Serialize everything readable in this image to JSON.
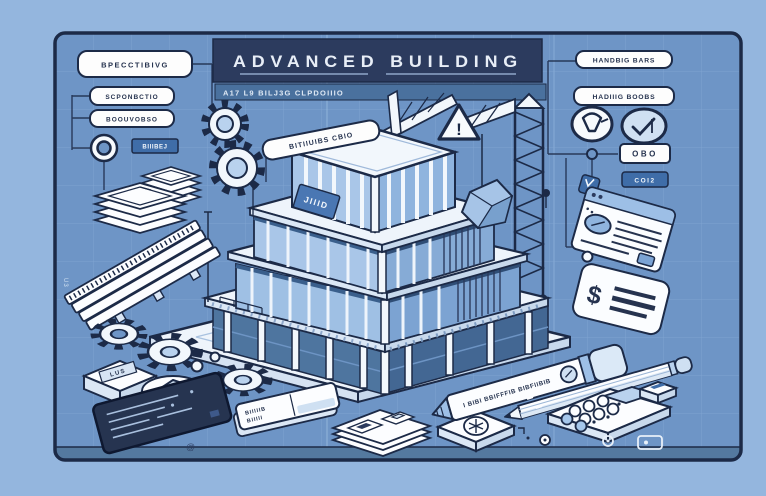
{
  "palette": {
    "outer_background": "#94b6de",
    "panel_background": "#6e95c6",
    "grid_line": "#7fa4d0",
    "ink_outline": "#1c2a47",
    "banner_background": "#2c3b5e",
    "banner_text": "#e8eef7",
    "subtitle_strip": "#4a719e",
    "object_white": "#fcfdff",
    "glass_light": "#b9d2ee",
    "glass_mid": "#7ca3d2",
    "glass_dark": "#3f6899",
    "accent_tag_blue": "#3f6da8",
    "tablet_dark": "#263450"
  },
  "title_block": {
    "title": "ADVANCED BUILDING",
    "subtitle": "A17 L9 BILJ3G CLPDOIIIO"
  },
  "labels": {
    "left_1": "BPECCTIBIVG",
    "left_2": "SCPONBCTIO",
    "left_3": "BOOUVOBSO",
    "left_tag": "BIIIBEJ",
    "right_1": "HANDBIG BARS",
    "right_2": "HADIIIG BOOBS",
    "right_tag_1": "OBO",
    "right_tag_2": "COI2",
    "building_flag": "BITIIUIBS CBIO",
    "building_sign": "JIIID",
    "crate_tag": "LUS",
    "eraser_line_1": "BIIIIIB",
    "eraser_line_2": "BIIIII",
    "marker_text": "I BIBI BBIFFFIB BIBFIIBIB",
    "warning_mark": "!",
    "card_symbol": "$",
    "edge_mark": "U3",
    "spiral_mark": "@"
  },
  "icons": {
    "warning_triangle": "!",
    "check_badge": "check-mark",
    "funnel_badge": "funnel",
    "gears": "gear",
    "currency_card": "$",
    "asterisk_tile": "asterisk-in-circle",
    "ring_post": "double-ring",
    "browser_card": "document-window",
    "crane": "tower-crane"
  }
}
